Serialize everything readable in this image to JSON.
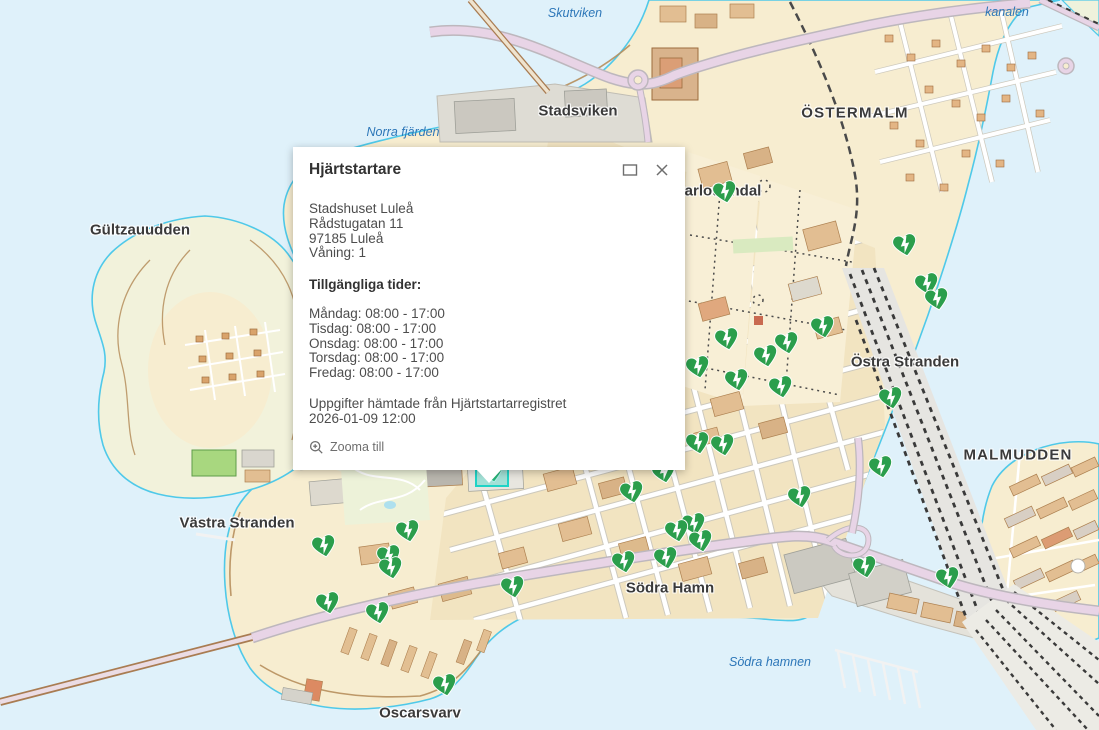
{
  "popup": {
    "title": "Hjärtstartare",
    "address_lines": [
      "Stadshuset Luleå",
      "Rådstugatan 11",
      "97185 Luleå",
      "Våning: 1"
    ],
    "availability_heading": "Tillgängliga tider:",
    "availability": [
      "Måndag: 08:00 - 17:00",
      "Tisdag: 08:00 - 17:00",
      "Onsdag: 08:00 - 17:00",
      "Torsdag: 08:00 - 17:00",
      "Fredag: 08:00 - 17:00"
    ],
    "source_lines": [
      "Uppgifter hämtade från Hjärtstartarregistret",
      "2026-01-09 12:00"
    ],
    "zoom_to_label": "Zooma till"
  },
  "map": {
    "labels": [
      {
        "text": "Skutviken",
        "x": 575,
        "y": 13,
        "type": "water"
      },
      {
        "text": "kanalen",
        "x": 1007,
        "y": 12,
        "type": "water"
      },
      {
        "text": "Norra fjärden",
        "x": 403,
        "y": 132,
        "type": "water"
      },
      {
        "text": "Stadsviken",
        "x": 578,
        "y": 111,
        "type": "place"
      },
      {
        "text": "ÖSTERMALM",
        "x": 855,
        "y": 113,
        "type": "place-caps"
      },
      {
        "text": "Gültzauudden",
        "x": 140,
        "y": 230,
        "type": "place"
      },
      {
        "text": "Charlottendal",
        "x": 713,
        "y": 191,
        "type": "place"
      },
      {
        "text": "Östra Stranden",
        "x": 905,
        "y": 362,
        "type": "place"
      },
      {
        "text": "MALMUDDEN",
        "x": 1018,
        "y": 455,
        "type": "place-caps"
      },
      {
        "text": "Västra Stranden",
        "x": 237,
        "y": 523,
        "type": "place"
      },
      {
        "text": "Södra Hamn",
        "x": 670,
        "y": 588,
        "type": "place"
      },
      {
        "text": "Södra hamnen",
        "x": 770,
        "y": 662,
        "type": "water"
      },
      {
        "text": "Oscarsvarv",
        "x": 420,
        "y": 713,
        "type": "place"
      }
    ],
    "markers": [
      {
        "x": 492,
        "y": 471,
        "selected": true
      },
      {
        "x": 725,
        "y": 192
      },
      {
        "x": 905,
        "y": 245
      },
      {
        "x": 927,
        "y": 284
      },
      {
        "x": 937,
        "y": 299
      },
      {
        "x": 823,
        "y": 327
      },
      {
        "x": 727,
        "y": 339
      },
      {
        "x": 787,
        "y": 343
      },
      {
        "x": 766,
        "y": 356
      },
      {
        "x": 698,
        "y": 367
      },
      {
        "x": 737,
        "y": 380
      },
      {
        "x": 781,
        "y": 387
      },
      {
        "x": 891,
        "y": 398
      },
      {
        "x": 881,
        "y": 467
      },
      {
        "x": 865,
        "y": 567
      },
      {
        "x": 948,
        "y": 578
      },
      {
        "x": 698,
        "y": 443
      },
      {
        "x": 723,
        "y": 445
      },
      {
        "x": 664,
        "y": 472
      },
      {
        "x": 632,
        "y": 492
      },
      {
        "x": 800,
        "y": 497
      },
      {
        "x": 694,
        "y": 524
      },
      {
        "x": 677,
        "y": 531
      },
      {
        "x": 701,
        "y": 541
      },
      {
        "x": 624,
        "y": 562
      },
      {
        "x": 666,
        "y": 558
      },
      {
        "x": 408,
        "y": 531
      },
      {
        "x": 324,
        "y": 546
      },
      {
        "x": 389,
        "y": 556
      },
      {
        "x": 391,
        "y": 568
      },
      {
        "x": 513,
        "y": 587
      },
      {
        "x": 328,
        "y": 603
      },
      {
        "x": 378,
        "y": 613
      },
      {
        "x": 445,
        "y": 685
      }
    ],
    "marker_meaning": "defibrillator-location",
    "colors": {
      "marker_green": "#2b9e4c",
      "selection_teal": "#1fd3c6",
      "water": "#dff1fa",
      "land": "#f7edd0",
      "road_major": "#e8d4e6",
      "water_label": "#2c76b8",
      "place_label": "#3a3a3a"
    }
  }
}
